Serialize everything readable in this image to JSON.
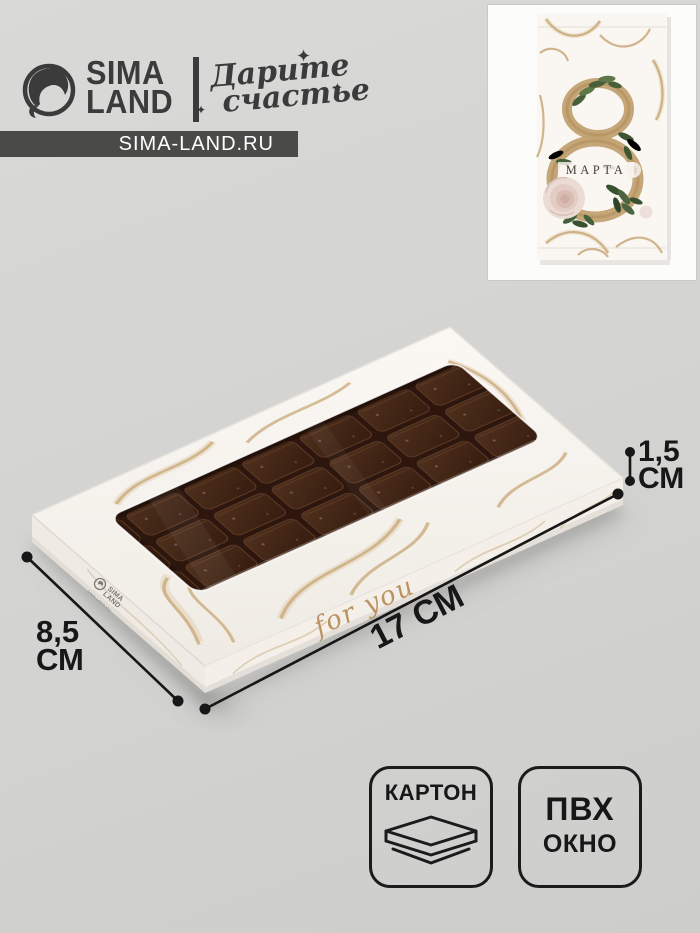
{
  "header": {
    "logo_line1": "SIMA",
    "logo_line2": "LAND",
    "tagline_line1": "Дарите",
    "tagline_line2": "счастье",
    "sparkle_glyph": "✦",
    "url": "SIMA-LAND.RU"
  },
  "inset": {
    "number": "8",
    "label": "МАРТА"
  },
  "product": {
    "front_text": "for you",
    "side_logo": {
      "line1": "SIMA",
      "line2": "LAND",
      "line3": "SIMA-LAND.RU"
    }
  },
  "dimensions": {
    "length": "17 СМ",
    "width_value": "8,5",
    "width_unit": "СМ",
    "height_value": "1,5",
    "height_unit": "СМ"
  },
  "badges": [
    {
      "label": "КАРТОН",
      "icon": "cardboard-layers"
    },
    {
      "line1": "ПВХ",
      "line2": "ОКНО"
    }
  ],
  "colors": {
    "gold_accent": "#c8a877",
    "chocolate": "#3a2013",
    "box_white": "#f9f6f1",
    "url_bar_bg": "#4a4a48",
    "annotation": "#171717",
    "background": "#d3d3d1"
  }
}
